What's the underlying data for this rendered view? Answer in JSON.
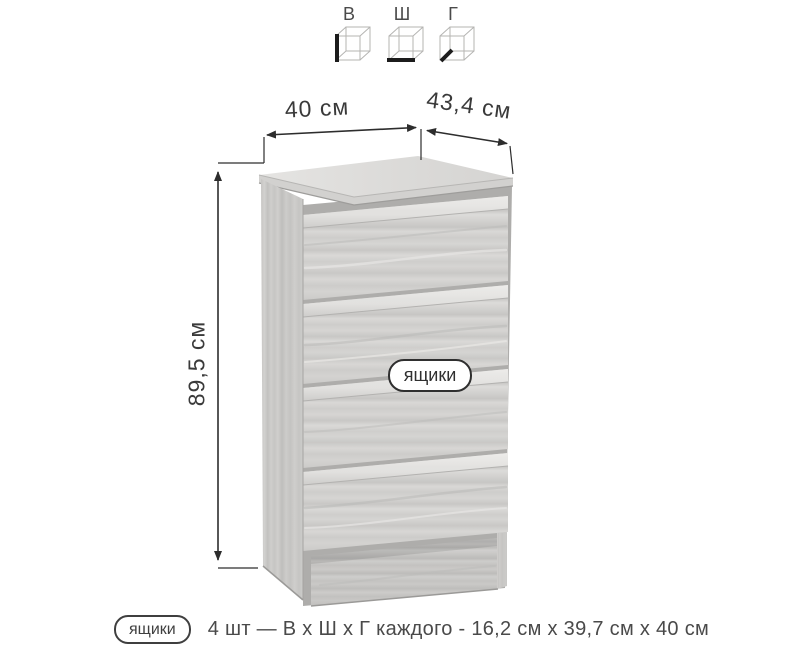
{
  "legend": {
    "cubes": [
      {
        "label": "В"
      },
      {
        "label": "Ш"
      },
      {
        "label": "Г"
      }
    ]
  },
  "dimensions": {
    "width": "40 см",
    "depth": "43,4 см",
    "height": "89,5 см"
  },
  "callout": {
    "drawers": "ящики"
  },
  "footer": {
    "badge": "ящики",
    "description": "4 шт — В х Ш х Г каждого - 16,2 см х 39,7 см х 40 см"
  },
  "colors": {
    "line": "#2d2d2d",
    "text": "#3f3f3f",
    "wood_light": "#dcdbd9",
    "wood_dark": "#c6c5c3"
  }
}
